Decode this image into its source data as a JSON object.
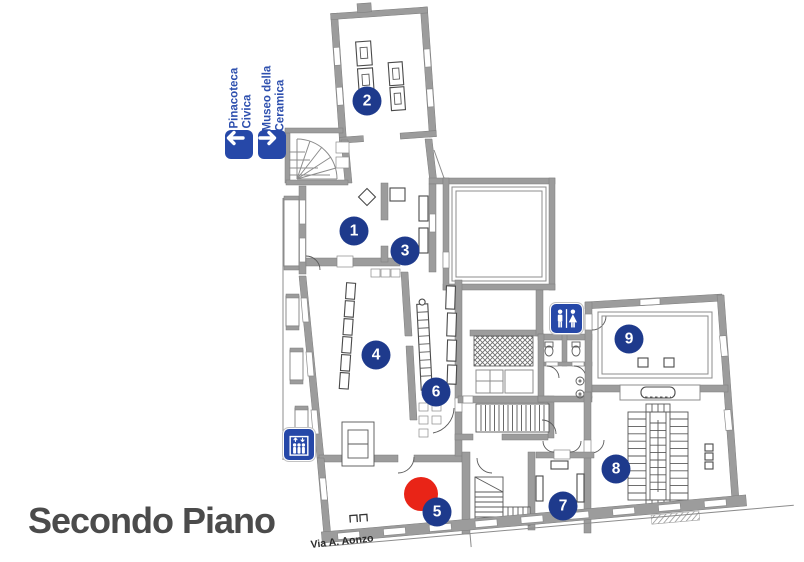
{
  "title": "Secondo Piano",
  "street_label": "Via A. Aonzo",
  "colors": {
    "marker_blue": "#1e3a8c",
    "sign_blue": "#2648a8",
    "sign_text_blue": "#2d4fae",
    "red": "#e92417",
    "wall_gray": "#9c9c9c",
    "title_gray": "#4b4b4b"
  },
  "direction_signs": [
    {
      "id": "pinacoteca-civica",
      "label_line1": "Pinacoteca",
      "label_line2": "Civica",
      "arrow": "left"
    },
    {
      "id": "museo-della-ceramica",
      "label_line1": "Museo della",
      "label_line2": "Ceramica",
      "arrow": "right"
    }
  ],
  "facility_signs": [
    {
      "id": "elevator",
      "icon": "elevator-icon"
    },
    {
      "id": "restroom",
      "icon": "restroom-icon"
    }
  ],
  "room_markers": [
    {
      "number": "1",
      "x": 354,
      "y": 231
    },
    {
      "number": "2",
      "x": 367,
      "y": 101
    },
    {
      "number": "3",
      "x": 405,
      "y": 251
    },
    {
      "number": "4",
      "x": 376,
      "y": 355
    },
    {
      "number": "5",
      "x": 437,
      "y": 512
    },
    {
      "number": "6",
      "x": 436,
      "y": 392
    },
    {
      "number": "7",
      "x": 563,
      "y": 506
    },
    {
      "number": "8",
      "x": 616,
      "y": 469
    },
    {
      "number": "9",
      "x": 629,
      "y": 339
    }
  ],
  "highlight_dot": {
    "x": 421,
    "y": 494,
    "radius": 17
  }
}
